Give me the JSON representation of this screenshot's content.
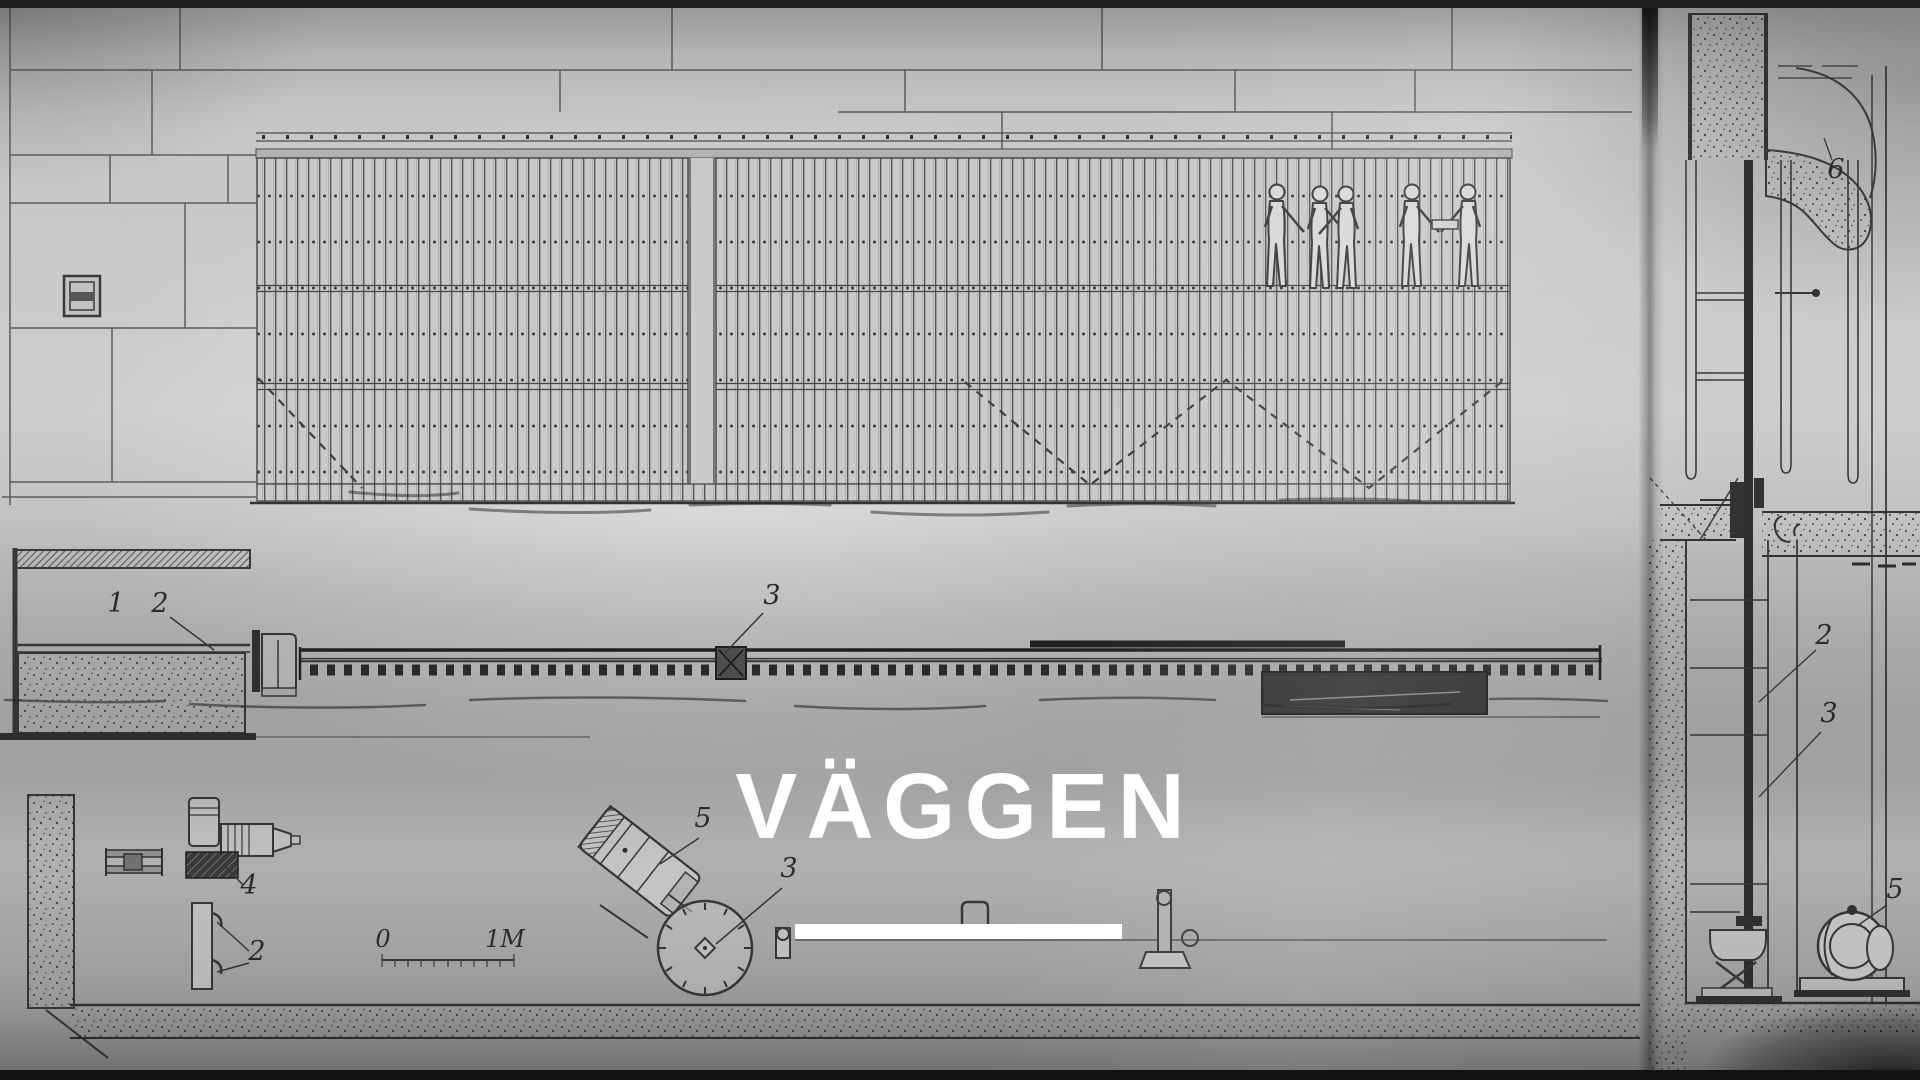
{
  "overlay": {
    "title": "VÄGGEN"
  },
  "colors": {
    "paper": "#c6c6c6",
    "ink": "#3a3a3a",
    "overlay_text": "#ffffff"
  },
  "drawing_labels": {
    "elevation": {
      "n1": "1",
      "n2": "2",
      "n3": "3"
    },
    "plan": {
      "n4": "4",
      "n2": "2",
      "n5": "5",
      "n3": "3"
    },
    "scale": {
      "zero": "0",
      "one_meter": "1M"
    },
    "section": {
      "n6": "6",
      "n2": "2",
      "n3": "3",
      "n5": "5"
    }
  }
}
